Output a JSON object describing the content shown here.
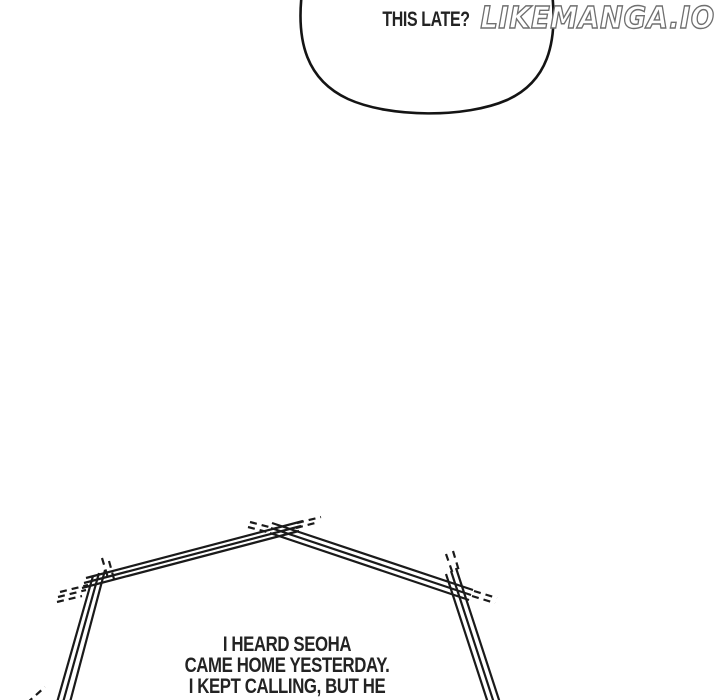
{
  "page": {
    "background_color": "#ffffff",
    "ink_color": "#1a1a1a",
    "dialogue_text_color": "#232323"
  },
  "watermark": {
    "text": "LIKEMANGA.IO",
    "outline_color": "#6f6f6f",
    "fill_color": "#ffffff"
  },
  "top_bubble": {
    "shape": "rounded-oval, cropped at top edge",
    "text": "THIS LATE?"
  },
  "bottom_bubble": {
    "shape": "jagged sketch bubble, triple parallel strokes with dashed overshoots, cropped at bottom edge",
    "lines": [
      "I HEARD SEOHA",
      "CAME HOME YESTERDAY.",
      "I KEPT CALLING, BUT HE"
    ]
  }
}
